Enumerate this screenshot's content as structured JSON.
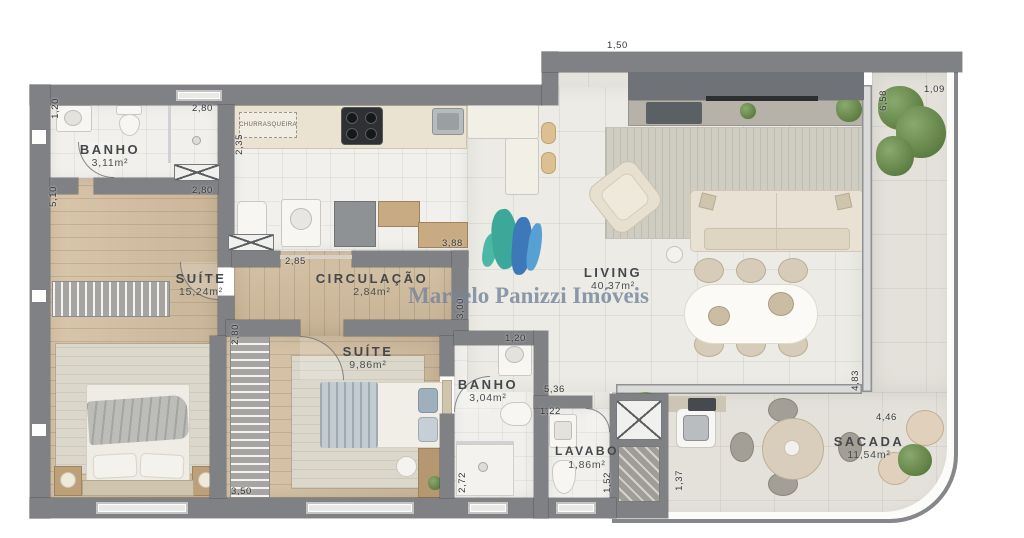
{
  "brand": {
    "watermark_text": "Marcelo Panizzi Imóveis"
  },
  "rooms": {
    "banho1": {
      "name": "BANHO",
      "area": "3,11m²"
    },
    "suite1": {
      "name": "SUÍTE",
      "area": "15,24m²"
    },
    "circulacao": {
      "name": "CIRCULAÇÃO",
      "area": "2,84m²"
    },
    "suite2": {
      "name": "SUÍTE",
      "area": "9,86m²"
    },
    "banho2": {
      "name": "BANHO",
      "area": "3,04m²"
    },
    "lavabo": {
      "name": "LAVABO",
      "area": "1,86m²"
    },
    "living": {
      "name": "LIVING",
      "area": "40,37m²"
    },
    "sacada": {
      "name": "SACADA",
      "area": "11,54m²"
    }
  },
  "features": {
    "churrasqueira": "CHURRASQUEIRA"
  },
  "dims": {
    "d1": "1,20",
    "d2": "2,80",
    "d3": "5,10",
    "d4": "2,80",
    "d5": "2,35",
    "d6": "2,85",
    "d7": "3,88",
    "d8": "1,50",
    "d9": "1,09",
    "d10": "6,58",
    "d11": "3,00",
    "d12": "2,80",
    "d13": "3,50",
    "d14": "1,20",
    "d15": "5,36",
    "d16": "1,22",
    "d17": "2,72",
    "d18": "1,52",
    "d19": "1,37",
    "d20": "4,83",
    "d21": "4,46"
  },
  "colors": {
    "wall": "#7f8184",
    "wood_floor": "#d2bc9e",
    "tile_floor": "#ecebe5",
    "logo_teal": "#2ea394",
    "logo_blue": "#2f6fb5",
    "watermark_text": "#76869d"
  }
}
